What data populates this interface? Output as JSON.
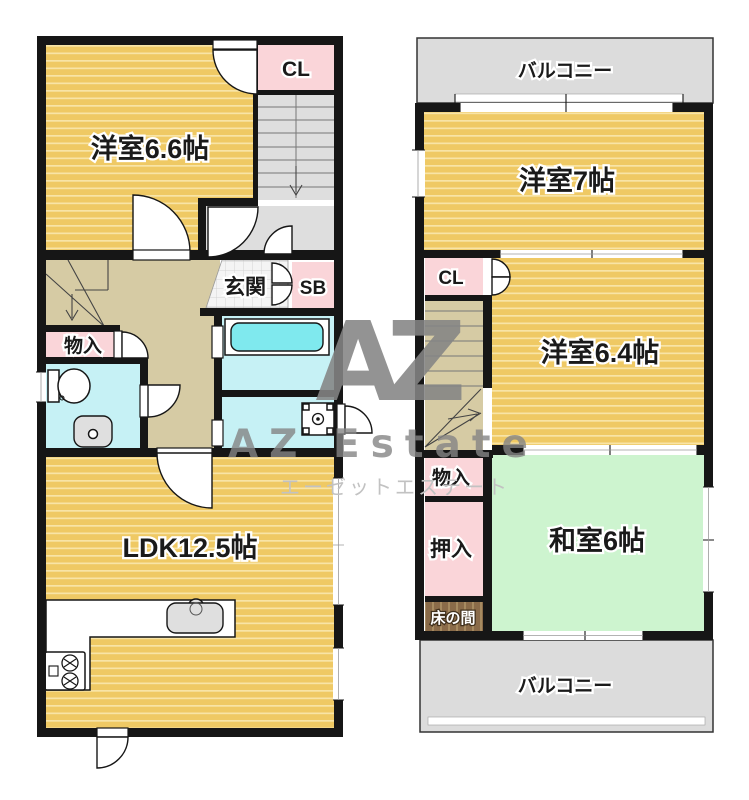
{
  "watermark": {
    "logo": "AZ",
    "name": "AZ Estate",
    "name_kana": "エーゼットエステート"
  },
  "floor1": {
    "west_room": "洋室6.6帖",
    "closet": "CL",
    "entrance": "玄関",
    "shoe_box": "SB",
    "storage": "物入",
    "ldk": "LDK12.5帖"
  },
  "floor2": {
    "balcony_top": "バルコニー",
    "west_room_7": "洋室7帖",
    "closet": "CL",
    "west_room_6_4": "洋室6.4帖",
    "storage": "物入",
    "oshiire": "押入",
    "tokonoma": "床の間",
    "japanese_room": "和室6帖",
    "balcony_bottom": "バルコニー"
  },
  "colors": {
    "wall": "#161616",
    "room_tatami": "#EFC964",
    "room_tatami_stripe": "#F8E4A6",
    "hall": "#D6CBA4",
    "stair_gray": "#DEDEDE",
    "closet_pink": "#FAD5D9",
    "wet_area": "#C6F1F5",
    "bathtub": "#7FE9EE",
    "japanese_room": "#CDF4CF",
    "balcony": "#DCDCDC",
    "tokonoma": "#8A6B49",
    "tokonoma_stripe": "#A68A60",
    "tile_bg": "#F4F4F4",
    "tile_line": "#D3D3D3",
    "fixture_gray": "#DFDFDF",
    "watermark": "#858585",
    "watermark_kana": "#C2C2C2"
  }
}
